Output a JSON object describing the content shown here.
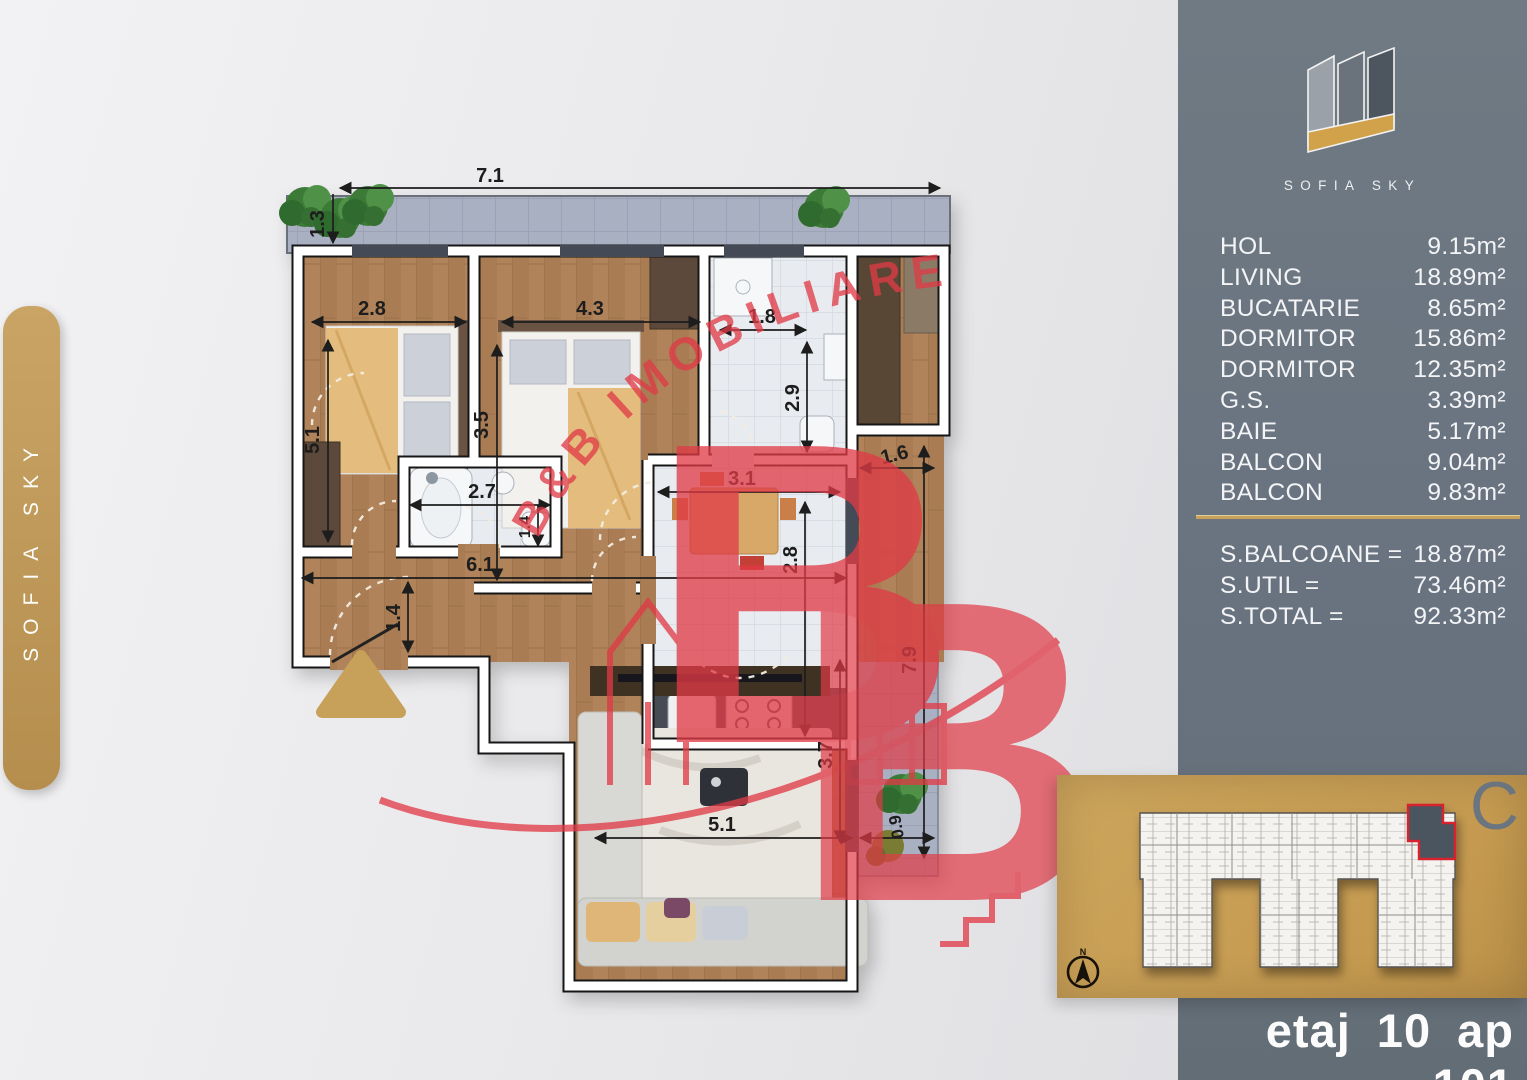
{
  "side_tab": {
    "label": "SOFIA SKY"
  },
  "logo": {
    "title": "SOFIA SKY"
  },
  "summary": {
    "rooms": [
      {
        "label": "HOL",
        "area": "9.15m²"
      },
      {
        "label": "LIVING",
        "area": "18.89m²"
      },
      {
        "label": "BUCATARIE",
        "area": "8.65m²"
      },
      {
        "label": "DORMITOR",
        "area": "15.86m²"
      },
      {
        "label": "DORMITOR",
        "area": "12.35m²"
      },
      {
        "label": "G.S.",
        "area": "3.39m²"
      },
      {
        "label": "BAIE",
        "area": "5.17m²"
      },
      {
        "label": "BALCON",
        "area": "9.04m²"
      },
      {
        "label": "BALCON",
        "area": "9.83m²"
      }
    ],
    "totals": [
      {
        "label": "S.BALCOANE =",
        "value": "18.87m²"
      },
      {
        "label": "S.UTIL =",
        "value": "73.46m²"
      },
      {
        "label": "S.TOTAL =",
        "value": "92.33m²"
      }
    ]
  },
  "site_plan": {
    "section_letter": "C",
    "compass": "N"
  },
  "footer": {
    "label": "etaj 10 ap 101"
  },
  "watermark": {
    "text": "B&B IMOBILIARE",
    "letter": "B"
  },
  "plan_dims": {
    "balcony_top_w": "7.1",
    "balcony_top_d": "1.3",
    "bed1_w": "2.8",
    "bed1_h": "5.1",
    "bed2_w": "4.3",
    "bed2_h": "3.5",
    "gs_w": "1.8",
    "gs_h": "2.9",
    "bath_w": "2.7",
    "bath_h": "1.4",
    "hall_w": "6.1",
    "hall_h": "1.4",
    "kitchen_w": "3.1",
    "kitchen_h": "2.8",
    "balcony_right_w": "1.6",
    "balcony_right_h": "7.9",
    "living_w": "5.1",
    "living_h": "3.7",
    "balcony_bottom_w": "0.9"
  },
  "colors": {
    "gold": "#c7a05a",
    "panel_gray": "#6a747d",
    "watermark_red": "#e13a46"
  }
}
